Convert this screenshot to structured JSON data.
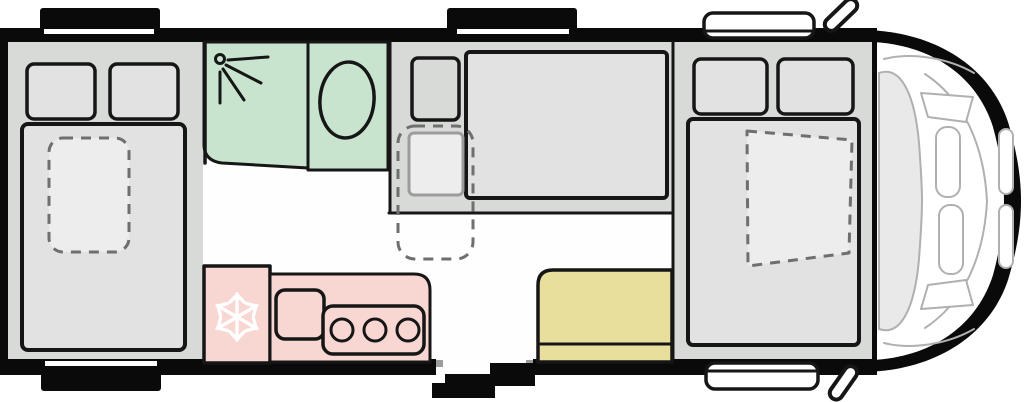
{
  "figure": {
    "kind": "motorhome-floorplan-top-view"
  },
  "colors": {
    "body_black": "#0a0a0a",
    "floor_white": "#fefefe",
    "panel_gray": "#d8dad8",
    "mattress_gray": "#e1e2e1",
    "cushion_light": "#ededed",
    "bathroom_green": "#c9e4ce",
    "kitchen_pink": "#f8d6d2",
    "bench_yellow": "#e9df9c",
    "outline_ink": "#161616",
    "dashed_gray": "#6f6f6f",
    "windshield_gray": "#e9e9e9",
    "cab_line_gray": "#b0b0b0",
    "icon_white": "#ffffff"
  },
  "icons": {
    "fridge": "snowflake-icon",
    "shower": "shower-head-icon",
    "toilet": "toilet-bowl-shape"
  }
}
